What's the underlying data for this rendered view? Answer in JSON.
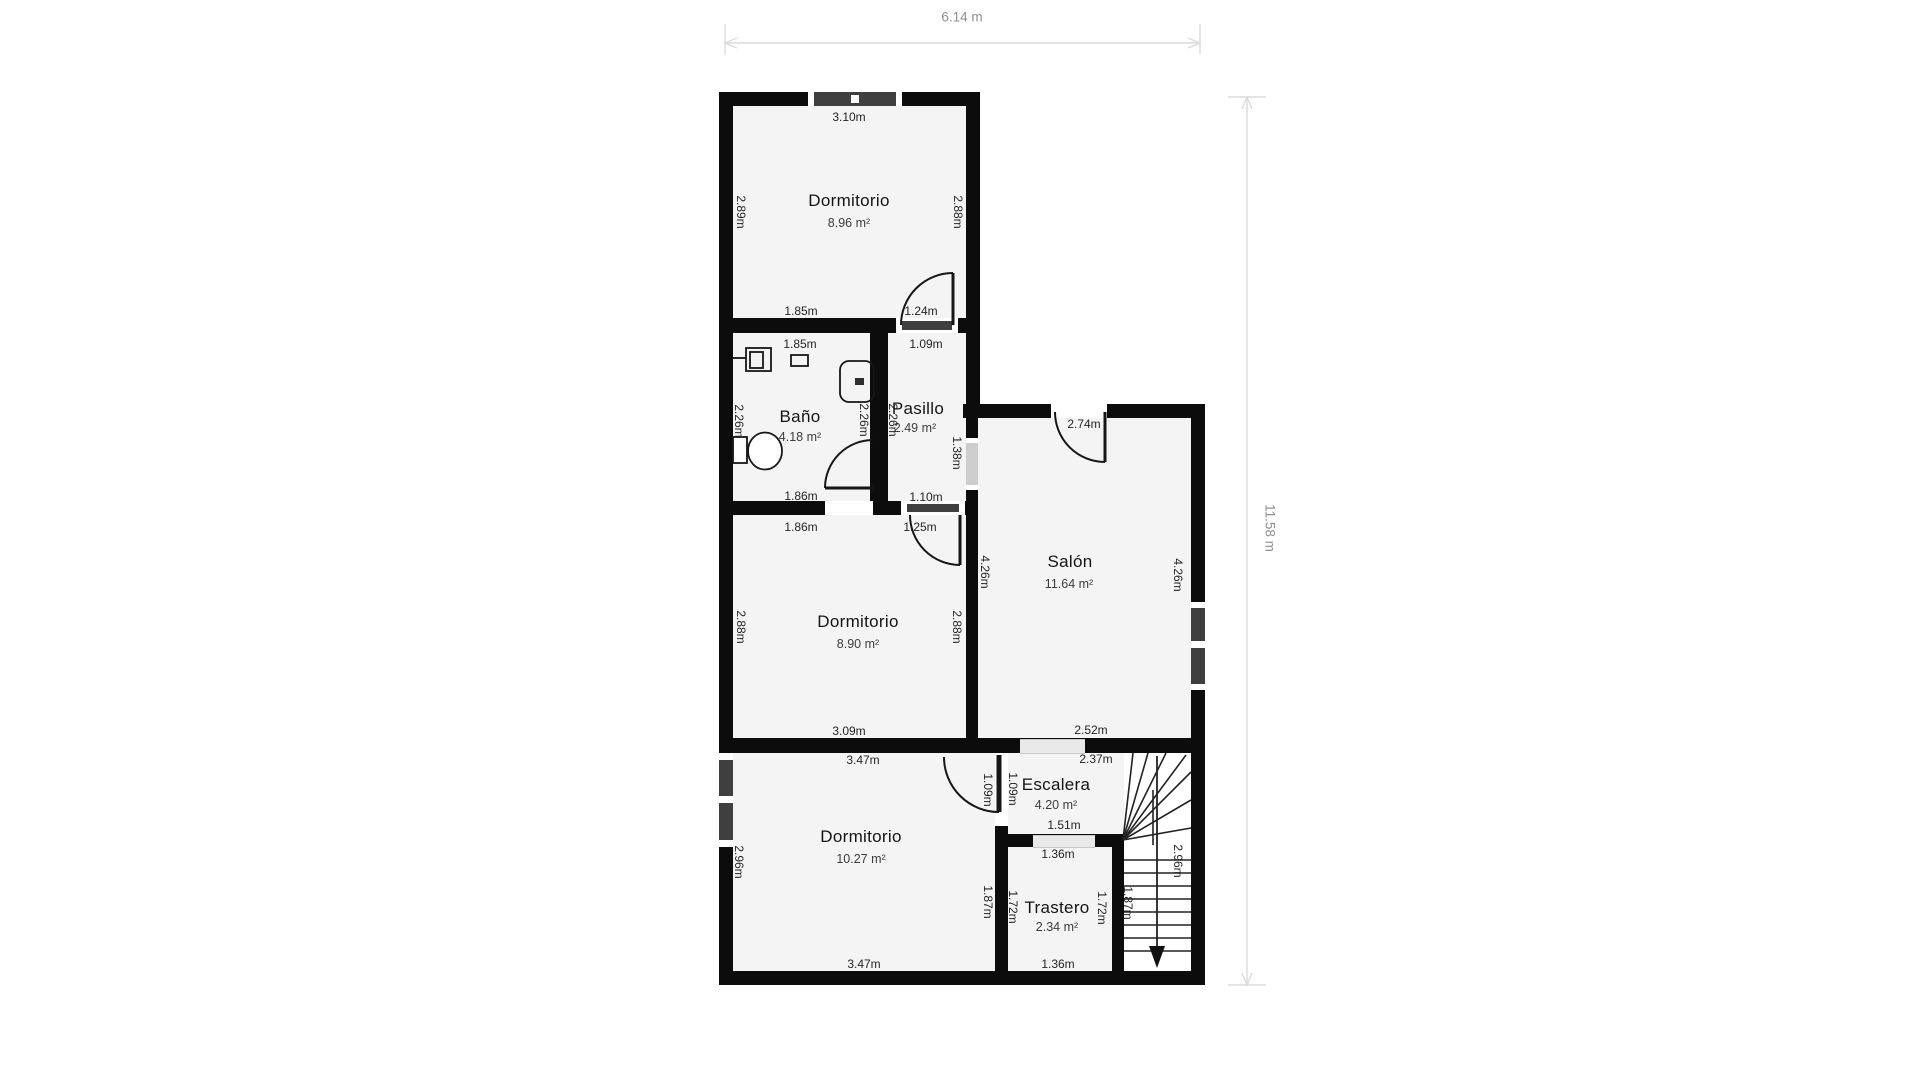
{
  "overall": {
    "width": "6.14 m",
    "height": "11.58 m"
  },
  "rooms": {
    "dormitorio1": {
      "name": "Dormitorio",
      "area": "8.96 m²",
      "labels": {
        "top": "3.10m",
        "left": "2.89m",
        "right": "2.88m",
        "bottom_left": "1.85m",
        "bottom_right": "1.24m"
      }
    },
    "bano": {
      "name": "Baño",
      "area": "4.18 m²",
      "labels": {
        "top": "1.85m",
        "left": "2.26m",
        "right": "2.26m",
        "bottom": "1.86m"
      }
    },
    "pasillo": {
      "name": "Pasillo",
      "area": "2.49 m²",
      "labels": {
        "top": "1.09m",
        "left": "2.26m",
        "right": "1.38m",
        "bottom": "1.10m"
      }
    },
    "salon": {
      "name": "Salón",
      "area": "11.64 m²",
      "labels": {
        "top": "2.74m",
        "left": "4.26m",
        "right": "4.26m",
        "bottom": "2.52m"
      }
    },
    "dormitorio2": {
      "name": "Dormitorio",
      "area": "8.90 m²",
      "labels": {
        "top_left": "1.86m",
        "top_right": "1.25m",
        "left": "2.88m",
        "right": "2.88m",
        "bottom": "3.09m"
      }
    },
    "dormitorio3": {
      "name": "Dormitorio",
      "area": "10.27 m²",
      "labels": {
        "top": "3.47m",
        "left": "2.96m",
        "right": "1.87m",
        "bottom": "3.47m",
        "door": "1.09m"
      }
    },
    "escalera": {
      "name": "Escalera",
      "area": "4.20 m²",
      "labels": {
        "top": "2.37m",
        "left": "1.09m",
        "bottom": "1.51m"
      }
    },
    "trastero": {
      "name": "Trastero",
      "area": "2.34 m²",
      "labels": {
        "top": "1.36m",
        "left": "1.72m",
        "right": "1.72m",
        "bottom": "1.36m"
      }
    },
    "stairs": {
      "labels": {
        "left": "1.87m",
        "right": "2.96m"
      }
    }
  },
  "colors": {
    "wall": "#0c0c0c",
    "room_fill": "#f4f4f4",
    "window_glass": "#3f3f3f",
    "threshold": "#e9e9e9",
    "dimension_line": "#dcdcdc",
    "dimension_text": "#8f8f8f"
  }
}
